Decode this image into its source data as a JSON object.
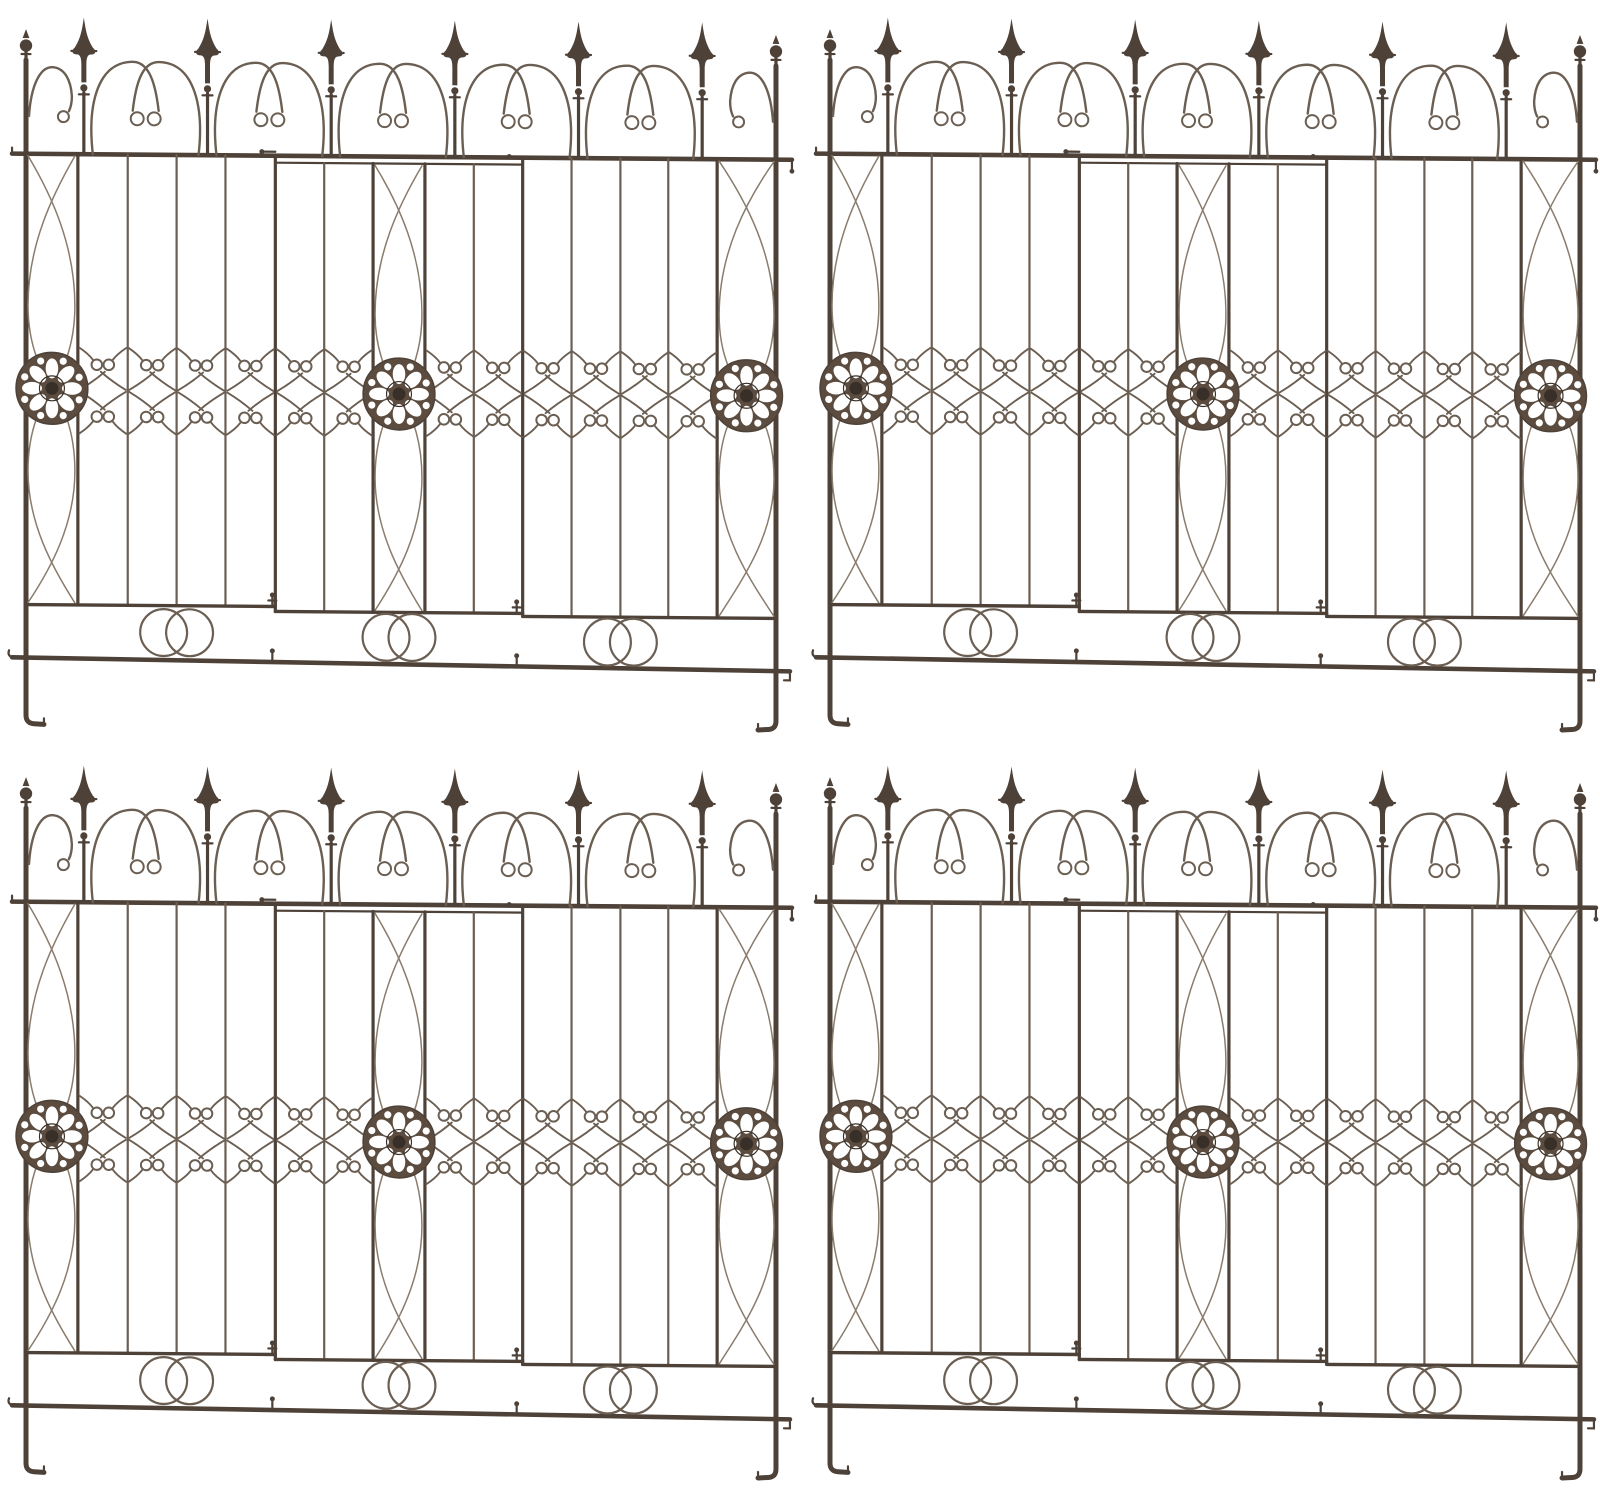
{
  "image": {
    "kind": "product-photo",
    "background": "#ffffff",
    "layout": "2x2-grid",
    "panel_count": 4
  },
  "panels": [
    {
      "name": "wrought-iron garden fence panel, top left"
    },
    {
      "name": "wrought-iron garden fence panel, top right"
    },
    {
      "name": "wrought-iron garden fence panel, bottom left"
    },
    {
      "name": "wrought-iron garden fence panel, bottom right"
    }
  ],
  "panel_features": {
    "spear_finials": 6,
    "ball_post_finials": 2,
    "arch_scroll_bays": 5,
    "end_arch_scrolls": 2,
    "vertical_sections": 3,
    "rosette_medallions": 3,
    "c_scroll_motifs": 12,
    "ellipse_lattice_columns": 3,
    "interlocking_circle_pairs": 3,
    "ground_stakes": 2
  },
  "colors": {
    "background": "#ffffff",
    "iron_dark": "#4d4138",
    "iron": "#6b5e52",
    "iron_light": "#8a7c6c",
    "rosette_body": "#5b4c3f",
    "rosette_center": "#383028",
    "cutout": "#ffffff",
    "css_vars": "--bg:#ffffff;--iron-dark:#4d4138;--iron:#6b5e52;--iron-light:#8a7c6c;--rosette:#5b4c3f;--rosette-center:#383028;--cutout:#ffffff"
  }
}
